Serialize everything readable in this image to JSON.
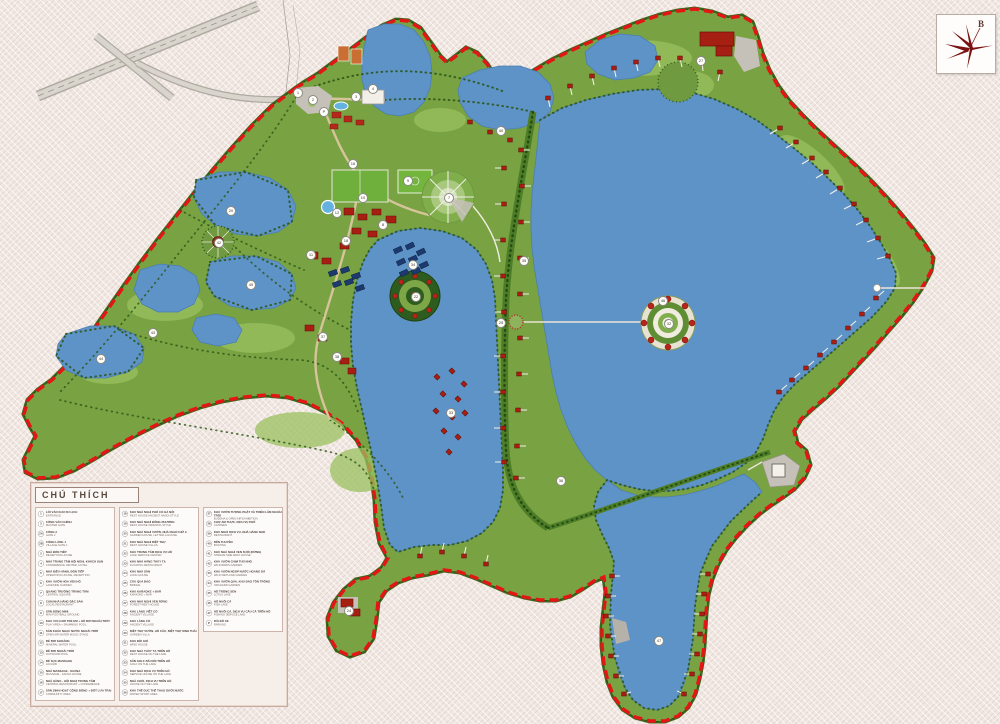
{
  "compass": {
    "north_label": "B"
  },
  "legend": {
    "title": "CHÚ THÍCH",
    "columns": [
      [
        {
          "no": "1",
          "vi": "LỐI VÀO KHU DU LỊCH",
          "en": "ENTRANCE"
        },
        {
          "no": "2",
          "vi": "CỔNG VÀO CHÍNH",
          "en": "MASTER GATE"
        },
        {
          "no": "2A",
          "vi": "CỔNG 2",
          "en": "GATE 2"
        },
        {
          "no": "2B",
          "vi": "CỔNG LÀNG 1",
          "en": "VILLAGE GATE 1"
        },
        {
          "no": "3",
          "vi": "NHÀ ĐÓN TIẾP",
          "en": "RECEPTION HOUSE"
        },
        {
          "no": "4",
          "vi": "NHÀ TRUNG TÂM HỘI NGHỊ, KHÁCH SẠN",
          "en": "CONFERENCE CENTER, HOTEL"
        },
        {
          "no": "5",
          "vi": "NHÀ ĐIỀU HÀNH, ĐÓN TIẾP",
          "en": "OPERATION HOUSE, RECEPTION"
        },
        {
          "no": "6",
          "vi": "KHU VƯỜN HOA VEN HỒ",
          "en": "LAKESIDE GARDEN"
        },
        {
          "no": "7",
          "vi": "QUẢNG TRƯỜNG TRUNG TÂM",
          "en": "CENTRAL SQUARE"
        },
        {
          "no": "8",
          "vi": "CỤM NHÀ HÀNG ĐẶC SẢN",
          "en": "LOCAL RESTAURANT"
        },
        {
          "no": "9",
          "vi": "SÂN BÓNG MINI",
          "en": "MINI FOOTBALL GROUND"
        },
        {
          "no": "10",
          "vi": "KHU VUI CHƠI TRẺ EM + HỒ BƠI NGOÀI TRỜI",
          "en": "PLAY AREA + SWIMMING POOL"
        },
        {
          "no": "11",
          "vi": "SÂN KHẤU NHẠC NƯỚC NGOÀI TRỜI",
          "en": "OPEN AIR WATER MUSIC STAGE"
        },
        {
          "no": "12",
          "vi": "BỂ BƠI KHOÁNG",
          "en": "MINERAL WATER POOL"
        },
        {
          "no": "13",
          "vi": "BỂ BƠI NGOÀI TRỜI",
          "en": "OUTDOOR POOL"
        },
        {
          "no": "14",
          "vi": "BỂ SỤC MASSAGE",
          "en": "JACUZZI"
        },
        {
          "no": "15",
          "vi": "NHÀ MASSAGE - SAUNA",
          "en": "MASSAGE - SAUNA HOUSE"
        },
        {
          "no": "16",
          "vi": "NHÀ HÀNG - HỘI NGHỊ TRUNG TÂM",
          "en": "CENTRAL RESTAURANT + CONFERENCE"
        },
        {
          "no": "17",
          "vi": "SÂN SINH HOẠT CỘNG ĐỒNG + ĐỐT LỬA TRẠI",
          "en": "COMMUNITY AREA"
        }
      ],
      [
        {
          "no": "18",
          "vi": "KHU NHÀ NGHỈ PHỐ CỔ HÀ NỘI",
          "en": "REST HOUSE ANCIENT HANOI STYLE"
        },
        {
          "no": "19",
          "vi": "KHU NHÀ NGHỈ ĐÔNG PHƯƠNG",
          "en": "REST HOUSE ORIENTAL STYLE"
        },
        {
          "no": "20",
          "vi": "KHU NHÀ NGHỈ VƯỜN, NHÀ NGHỈ CHỮ A",
          "en": "GARDEN HOUSE, LETTER-A HOUSE"
        },
        {
          "no": "21",
          "vi": "KHU NHÀ NGHỈ BIỆT THỰ",
          "en": "REST HOUSE VILLAS"
        },
        {
          "no": "22",
          "vi": "KHU TRUNG TÂM DỊCH VỤ HỒ",
          "en": "LAKE SERVICE CENTER"
        },
        {
          "no": "23",
          "vi": "KHU NHÀ HÀNG THỦY TẠ",
          "en": "FLOATING RESTAURANT"
        },
        {
          "no": "24",
          "vi": "KHU NHÀ SÀN",
          "en": "LONG HOUSE"
        },
        {
          "no": "25",
          "vi": "CẦU QUA ĐẢO",
          "en": "BRIDGE"
        },
        {
          "no": "26",
          "vi": "KHU KARAOKE + BAR",
          "en": "KARAOKE + BAR"
        },
        {
          "no": "27",
          "vi": "KHU NHÀ NGHỈ VEN RỪNG",
          "en": "FOREST REST HOUSE"
        },
        {
          "no": "28",
          "vi": "KHU LÀNG VIỆT CỔ",
          "en": "ANCIENT VILLAGE"
        },
        {
          "no": "29",
          "vi": "KHU LÀNG CỔ",
          "en": "ANCIENT VILLAGE"
        },
        {
          "no": "30",
          "vi": "BIỆT THỰ VƯỜN, HỒ CÂU, BIỆT THỰ SINH THÁI",
          "en": "GARDEN VILLA"
        },
        {
          "no": "31",
          "vi": "KHU ĐỒI GIÓ",
          "en": "WIND HOUSE"
        },
        {
          "no": "32",
          "vi": "KHU NHÀ THỦY TẠ TRÊN HỒ",
          "en": "REST HOUSE ON THE LAKE"
        },
        {
          "no": "33",
          "vi": "SÂN GOLF BÃI NỔI TRÊN HỒ",
          "en": "GOLF ON THE LAKE"
        },
        {
          "no": "34",
          "vi": "KHU NHÀ DỊCH VỤ TRÊN HỒ",
          "en": "SERVICE HOUSE ON THE LAKE"
        },
        {
          "no": "35",
          "vi": "NHÀ CHÒI, DỊCH VỤ TRÊN HỒ",
          "en": "HOUSE ON THE LAKE"
        },
        {
          "no": "36",
          "vi": "KHU THỂ DỤC THỂ THAO DƯỚI NƯỚC",
          "en": "WATER SPORT AREA"
        }
      ],
      [
        {
          "no": "37",
          "vi": "KHU VƯỜN TƯỢNG PHẬT VÀ TRIỂN LÃM NGOÀI TRỜI",
          "en": "BUDDHA & OPEN AIR EXHIBITION"
        },
        {
          "no": "38",
          "vi": "CHỢ ẨM THỰC, DỊCH VỤ PHỐ",
          "en": "CANTEEN"
        },
        {
          "no": "39",
          "vi": "KHU NGHỈ DỊCH VỤ, NHÀ HÀNG NHỎ",
          "en": "RESTAURANT"
        },
        {
          "no": "40",
          "vi": "BẾN THUYỀN",
          "en": "BOATING"
        },
        {
          "no": "41",
          "vi": "KHU NHÀ NGHỈ VEN SUỐI (RỪNG)",
          "en": "STREAM SIDE REST HOUSE"
        },
        {
          "no": "42",
          "vi": "KHU VƯỜN CHIM THÚ NHỎ",
          "en": "WILD BIRDS GARDEN"
        },
        {
          "no": "43",
          "vi": "KHU VƯỜN NGẬP NƯỚC HOANG DÃ",
          "en": "WILD WETLAND GARDEN"
        },
        {
          "no": "44",
          "vi": "KHU VƯỜN QUẢ, KHU BẢO TỒN TRỒNG",
          "en": "ORCHARD GARDEN"
        },
        {
          "no": "45",
          "vi": "HỒ TRỒNG SEN",
          "en": "LOTUS LAKE"
        },
        {
          "no": "46",
          "vi": "HỒ NUÔI CÁ",
          "en": "FISH LAKE"
        },
        {
          "no": "47",
          "vi": "HỒ NUÔI CÁ, DỊCH VỤ CÂU CÁ TRÊN HỒ",
          "en": "FISHING SERVICE LAKE"
        },
        {
          "no": "P",
          "vi": "BÃI ĐỖ XE",
          "en": "PARKING"
        }
      ]
    ]
  },
  "map": {
    "colors": {
      "lake": "#5e93c7",
      "land": "#79a243",
      "boundary_red": "#e31515",
      "background": "#f1e8e3",
      "building_red": "#a81f12",
      "road_gray": "#b7b2a9"
    },
    "markers": [
      {
        "no": "1",
        "x": 297,
        "y": 92
      },
      {
        "no": "2",
        "x": 312,
        "y": 99
      },
      {
        "no": "P",
        "x": 323,
        "y": 111
      },
      {
        "no": "3",
        "x": 355,
        "y": 96
      },
      {
        "no": "4",
        "x": 372,
        "y": 88
      },
      {
        "no": "40",
        "x": 500,
        "y": 130
      },
      {
        "no": "16",
        "x": 352,
        "y": 163
      },
      {
        "no": "9",
        "x": 407,
        "y": 180
      },
      {
        "no": "7",
        "x": 448,
        "y": 197
      },
      {
        "no": "10",
        "x": 362,
        "y": 197
      },
      {
        "no": "12",
        "x": 336,
        "y": 212
      },
      {
        "no": "8",
        "x": 382,
        "y": 224
      },
      {
        "no": "11",
        "x": 310,
        "y": 254
      },
      {
        "no": "18",
        "x": 345,
        "y": 240
      },
      {
        "no": "37",
        "x": 322,
        "y": 336
      },
      {
        "no": "38",
        "x": 336,
        "y": 356
      },
      {
        "no": "20",
        "x": 230,
        "y": 210
      },
      {
        "no": "42",
        "x": 218,
        "y": 242
      },
      {
        "no": "45",
        "x": 250,
        "y": 284
      },
      {
        "no": "43",
        "x": 152,
        "y": 332
      },
      {
        "no": "44",
        "x": 100,
        "y": 358
      },
      {
        "no": "46",
        "x": 662,
        "y": 300
      },
      {
        "no": "22",
        "x": 415,
        "y": 296
      },
      {
        "no": "25",
        "x": 500,
        "y": 322
      },
      {
        "no": "32",
        "x": 668,
        "y": 323
      },
      {
        "no": "34",
        "x": 412,
        "y": 264
      },
      {
        "no": "35",
        "x": 523,
        "y": 260
      },
      {
        "no": "33",
        "x": 450,
        "y": 412
      },
      {
        "no": "27",
        "x": 700,
        "y": 60
      },
      {
        "no": "47",
        "x": 658,
        "y": 640
      },
      {
        "no": "36",
        "x": 560,
        "y": 480
      },
      {
        "no": "24",
        "x": 348,
        "y": 610
      }
    ]
  }
}
